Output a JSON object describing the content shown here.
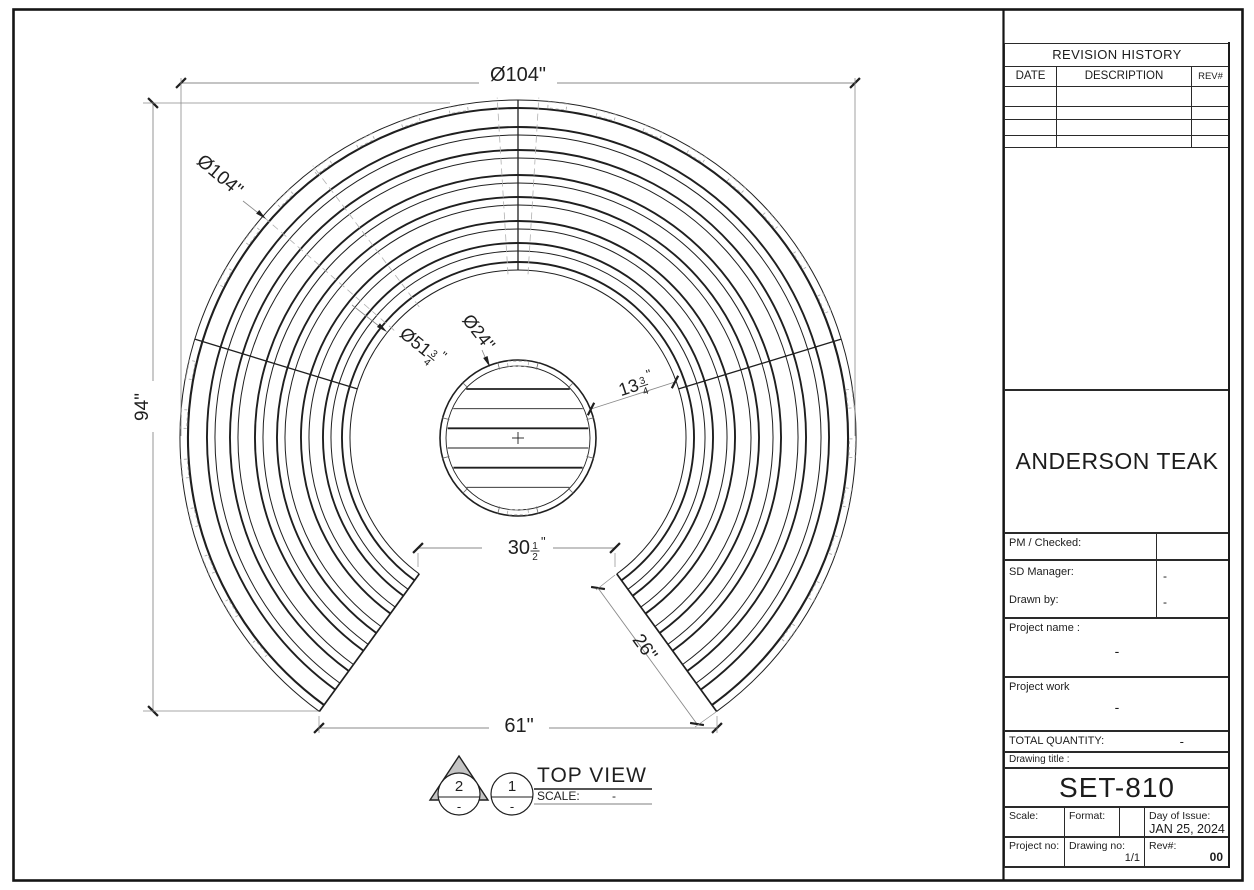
{
  "page": {
    "background": "#ffffff",
    "ink": "#1f1f1f",
    "dim_line_color": "#8a8a8a",
    "dash_color": "#b0b0b0"
  },
  "drawing": {
    "dimensions": {
      "overall_diameter_top": {
        "text": "Ø104\""
      },
      "overall_diameter_diag": {
        "text": "Ø104\""
      },
      "overall_height": {
        "text": "94\""
      },
      "table_diameter": {
        "text": "Ø24\""
      },
      "inner_bench_diameter": {
        "main": "Ø51",
        "num": "3",
        "den": "4"
      },
      "table_to_bench_gap": {
        "main": "13",
        "num": "3",
        "den": "4"
      },
      "opening_inner_width": {
        "main": "30",
        "num": "1",
        "den": "2"
      },
      "bench_end_length": {
        "text": "26\""
      },
      "opening_outer_width": {
        "text": "61\""
      }
    },
    "callouts": {
      "view_title": "TOP VIEW",
      "scale_label": "SCALE:",
      "scale_value": "-",
      "balloon_triangle": {
        "number": "2",
        "sub": "-"
      },
      "balloon_circle": {
        "number": "1",
        "sub": "-"
      }
    },
    "geometry": {
      "center": [
        518,
        438
      ],
      "scale_px_per_inch": 6.5,
      "ring_outer_radii": [
        338,
        311,
        288,
        263,
        241,
        217,
        195,
        176
      ],
      "ring_pair_offset": 8,
      "inner_edge_radius": 168,
      "outer_radius": 338,
      "gap_angles_deg": [
        54,
        126
      ],
      "joint_angles_deg": [
        197,
        270,
        343
      ],
      "dash_radial_angles_deg": [
        221,
        233,
        266.5,
        273.5
      ],
      "table_outer_radius": 78,
      "table_inner_radius": 72,
      "slat_offsets": [
        -49,
        -29.3,
        -9.7,
        10,
        29.7,
        49.3
      ]
    }
  },
  "title_block": {
    "revision_history": {
      "title": "REVISION HISTORY",
      "columns": [
        "DATE",
        "DESCRIPTION",
        "REV#"
      ],
      "empty_row_count": 4
    },
    "company_name": "ANDERSON TEAK",
    "pm_checked_label": "PM / Checked:",
    "sd_manager_label": "SD Manager:",
    "sd_manager_value": "-",
    "drawn_by_label": "Drawn by:",
    "drawn_by_value": "-",
    "project_name_label": "Project name :",
    "project_name_value": "-",
    "project_work_label": "Project work",
    "project_work_value": "-",
    "total_quantity_label": "TOTAL QUANTITY:",
    "total_quantity_value": "-",
    "drawing_title_label": "Drawing title :",
    "drawing_title_value": "SET-810",
    "scale_label": "Scale:",
    "format_label": "Format:",
    "day_of_issue_label": "Day of Issue:",
    "day_of_issue_value": "JAN 25, 2024",
    "project_no_label": "Project no:",
    "drawing_no_label": "Drawing no:",
    "drawing_no_value": "1/1",
    "rev_label": "Rev#:",
    "rev_value": "00"
  }
}
